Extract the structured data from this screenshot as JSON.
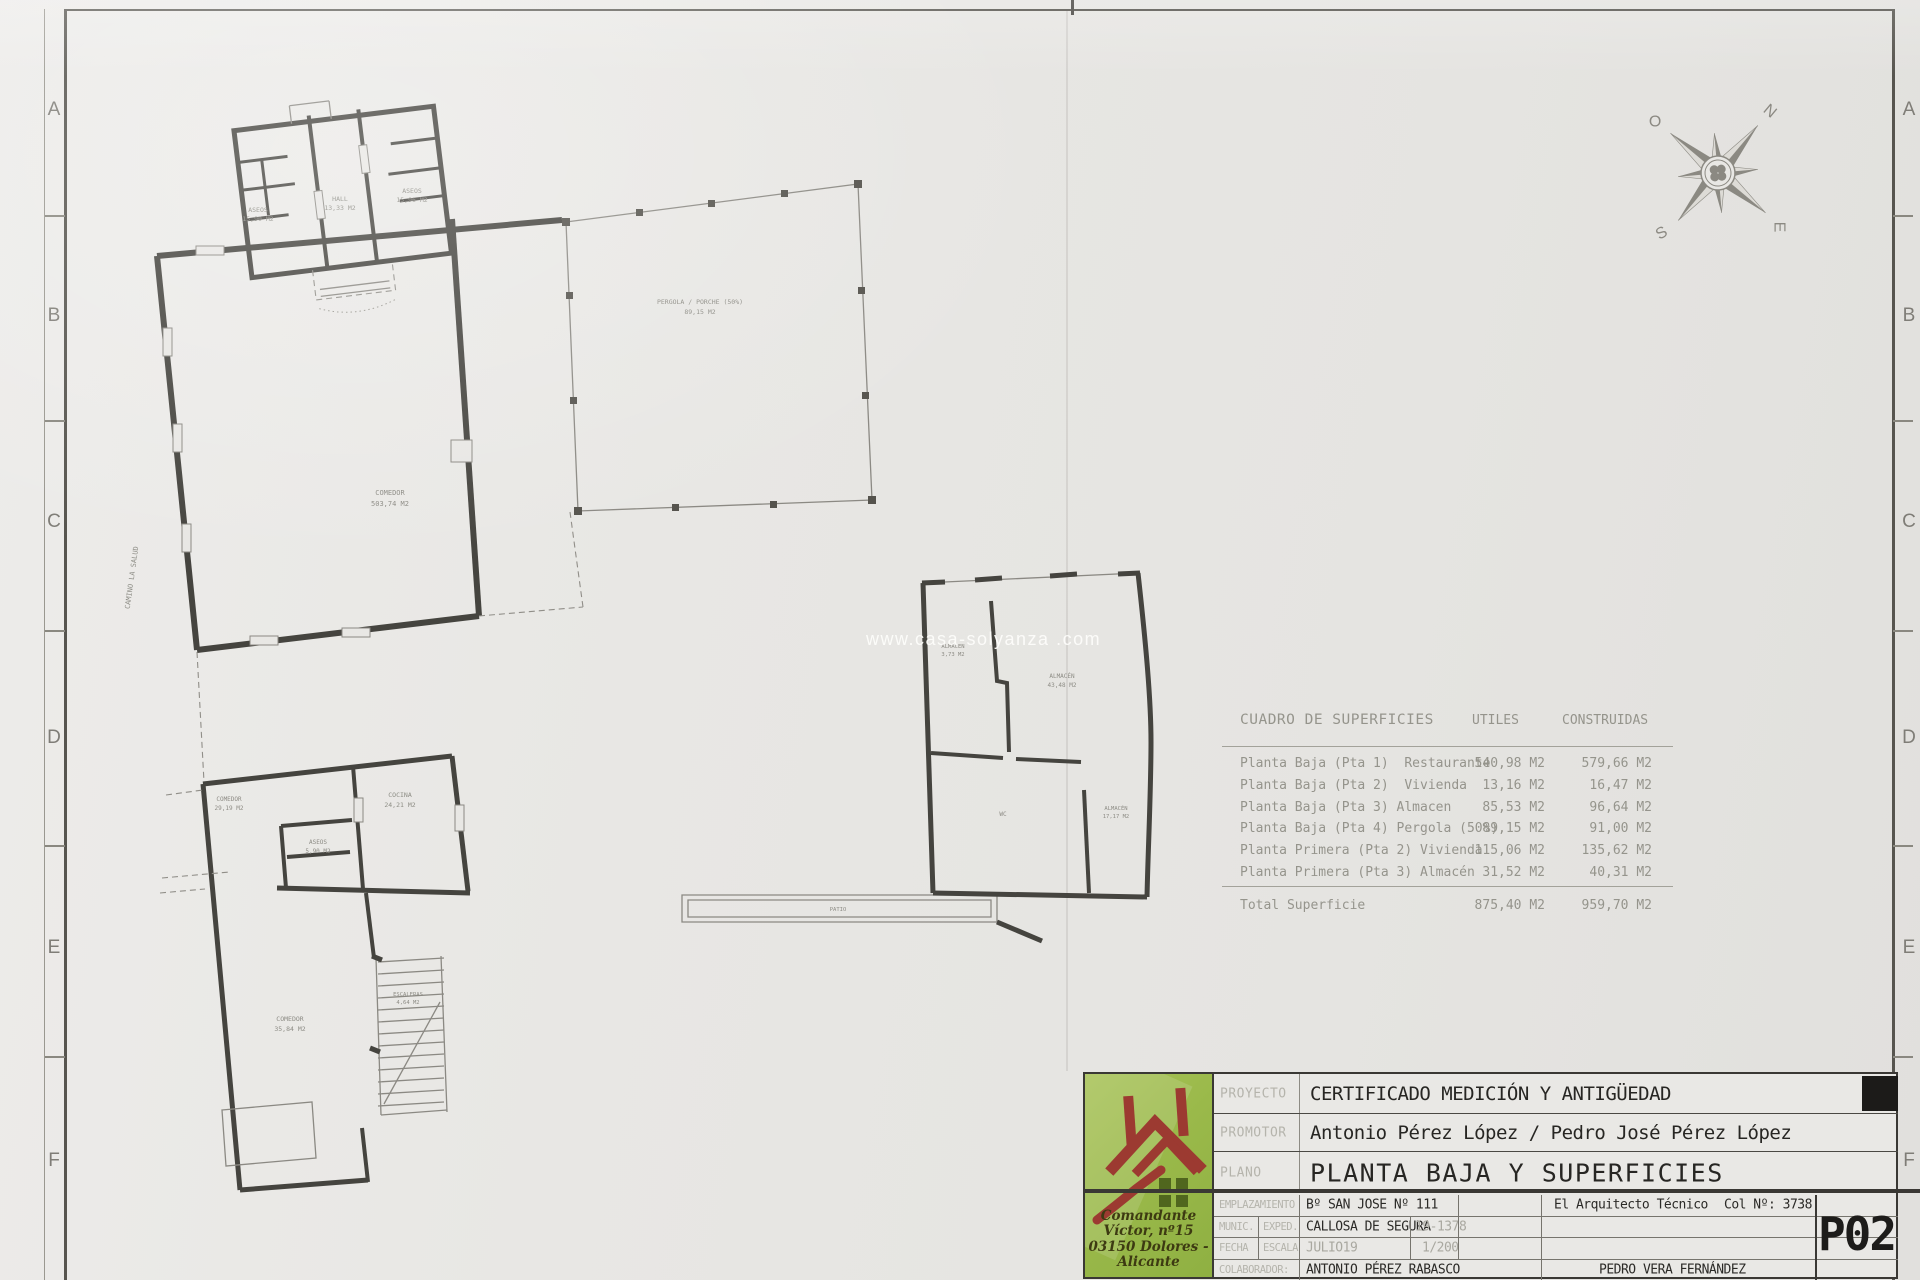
{
  "sheet": {
    "watermark": "www.casa-solyanza .com",
    "margin_letters": [
      "A",
      "B",
      "C",
      "D",
      "E",
      "F"
    ]
  },
  "compass": {
    "n": "N",
    "o": "O",
    "s": "S",
    "e": "E"
  },
  "plan": {
    "rooms": {
      "aseos_left": {
        "name": "ASEOS",
        "area": "15,90 M2"
      },
      "hall": {
        "name": "HALL",
        "area": "13,33 M2"
      },
      "aseos_right": {
        "name": "ASEOS",
        "area": "15,96 M2"
      },
      "comedor_main": {
        "name": "COMEDOR",
        "area": "503,74 M2"
      },
      "pergola": {
        "name": "PERGOLA / PORCHE (50%)",
        "area": "89,15 M2"
      },
      "camino": "CAMINO LA SALUD",
      "comedor_small": {
        "name": "COMEDOR",
        "area": "29,19 M2"
      },
      "cocina": {
        "name": "COCINA",
        "area": "24,21 M2"
      },
      "aseos_small": {
        "name": "ASEOS",
        "area": "5,90 M2"
      },
      "comedor_lower": {
        "name": "COMEDOR",
        "area": "35,84 M2"
      },
      "escaleras": {
        "name": "ESCALERAS",
        "area": "4,64 M2"
      },
      "almacen_1": {
        "name": "ALMACEN",
        "area": "3,73 M2"
      },
      "almacen_2": {
        "name": "ALMACÉN",
        "area": "43,48 M2"
      },
      "wc": {
        "name": "WC"
      },
      "almacen_3": {
        "name": "ALMACÉN",
        "area": "17,17 M2"
      },
      "patio": {
        "name": "PATIO"
      }
    }
  },
  "table": {
    "title": "CUADRO DE SUPERFICIES",
    "col_utiles": "UTILES",
    "col_construidas": "CONSTRUIDAS",
    "rows": [
      {
        "label": "Planta Baja (Pta 1)  Restaurante",
        "utiles": "540,98 M2",
        "construidas": "579,66 M2"
      },
      {
        "label": "Planta Baja (Pta 2)  Vivienda",
        "utiles": "13,16 M2",
        "construidas": "16,47 M2"
      },
      {
        "label": "Planta Baja (Pta 3) Almacen",
        "utiles": "85,53 M2",
        "construidas": "96,64 M2"
      },
      {
        "label": "Planta Baja (Pta 4) Pergola (50%)",
        "utiles": "89,15 M2",
        "construidas": "91,00 M2"
      },
      {
        "label": "Planta Primera (Pta 2) Vivienda",
        "utiles": "115,06 M2",
        "construidas": "135,62 M2"
      },
      {
        "label": "Planta Primera (Pta 3) Almacén",
        "utiles": "31,52 M2",
        "construidas": "40,31 M2"
      }
    ],
    "total_label": "Total Superficie",
    "total_utiles": "875,40 M2",
    "total_construidas": "959,70 M2"
  },
  "title_block": {
    "logo": {
      "address_line1": "Comandante Víctor, nº15",
      "address_line2": "03150 Dolores - Alicante"
    },
    "proyecto_label": "PROYECTO",
    "proyecto": "CERTIFICADO MEDICIÓN Y ANTIGÜEDAD",
    "promotor_label": "PROMOTOR",
    "promotor": "Antonio Pérez López / Pedro José Pérez López",
    "plano_label": "PLANO",
    "plano": "PLANTA BAJA Y SUPERFICIES",
    "emplazamiento_label": "EMPLAZAMIENTO",
    "emplazamiento": "Bº SAN JOSE Nº 111",
    "munic_label": "MUNIC.",
    "exped_label": "EXPED.",
    "municipio": "CALLOSA DE SEGURA",
    "expediente": "19-1378",
    "fecha_label": "FECHA",
    "escala_label": "ESCALA",
    "fecha": "JULIO19",
    "escala": "1/200",
    "colaborador_label": "COLABORADOR:",
    "colaborador": "ANTONIO PÉREZ RABASCO",
    "arquitecto": "El Arquitecto Técnico",
    "colegiado": "Col Nº: 3738",
    "tecnico": "PEDRO VERA FERNÁNDEZ",
    "plan_code": "P02"
  }
}
